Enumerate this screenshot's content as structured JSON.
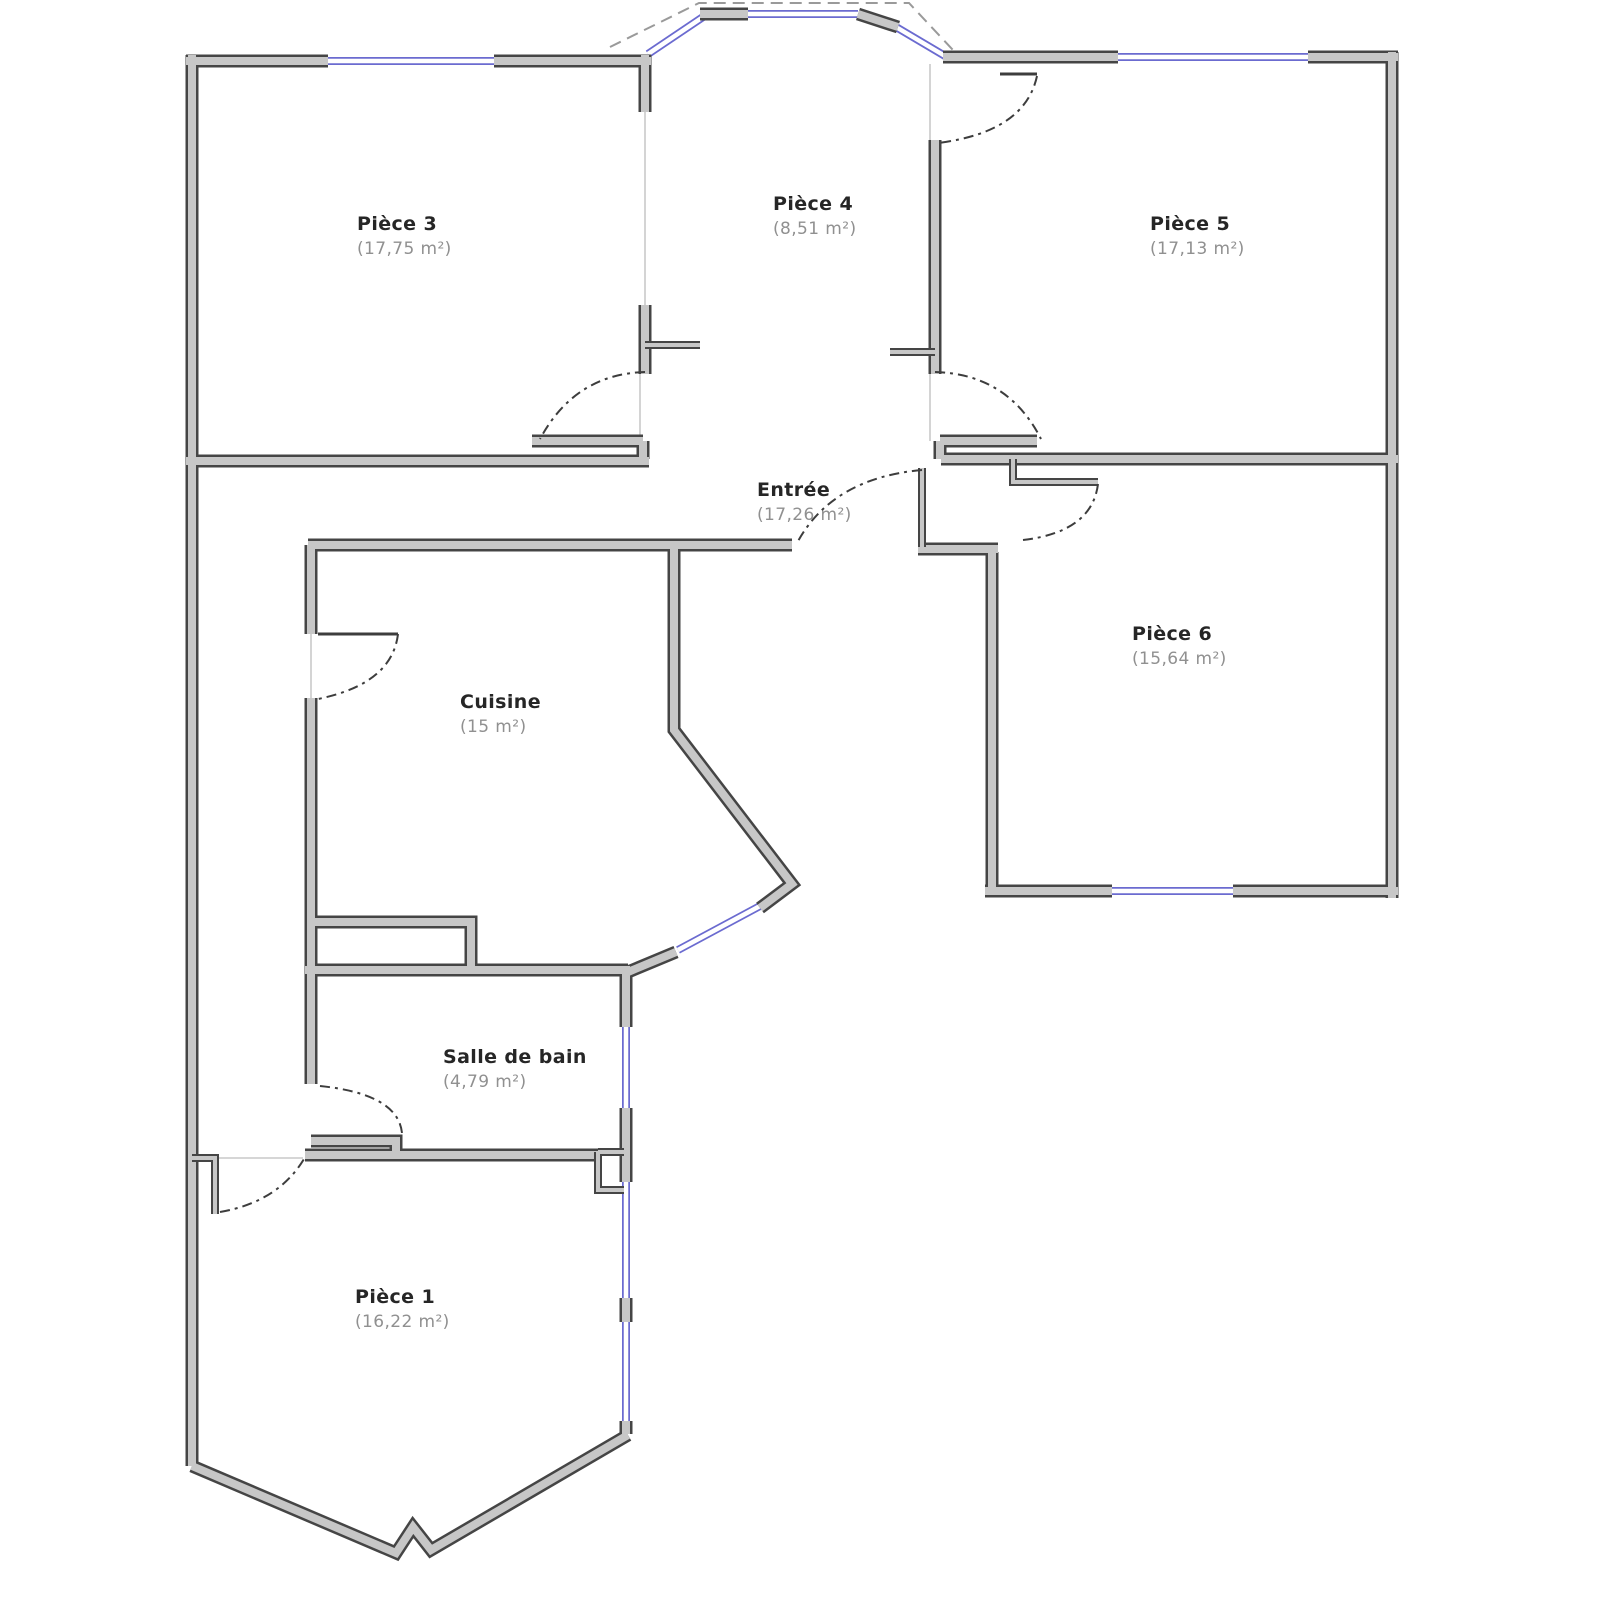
{
  "rooms": [
    {
      "name": "Pièce 3",
      "area": "(17,75 m²)"
    },
    {
      "name": "Pièce 4",
      "area": "(8,51 m²)"
    },
    {
      "name": "Pièce 5",
      "area": "(17,13 m²)"
    },
    {
      "name": "Entrée",
      "area": "(17,26 m²)"
    },
    {
      "name": "Pièce 6",
      "area": "(15,64 m²)"
    },
    {
      "name": "Cuisine",
      "area": "(15 m²)"
    },
    {
      "name": "Salle de bain",
      "area": "(4,79 m²)"
    },
    {
      "name": "Pièce 1",
      "area": "(16,22 m²)"
    }
  ],
  "colors": {
    "background": "#ffffff",
    "wall_outline": "#454545",
    "wall_fill": "#c7c7c7",
    "window": "#6b6bd0",
    "door_arc": "#3d3d3d",
    "room_name_text": "#262626",
    "room_area_text": "#909090"
  }
}
